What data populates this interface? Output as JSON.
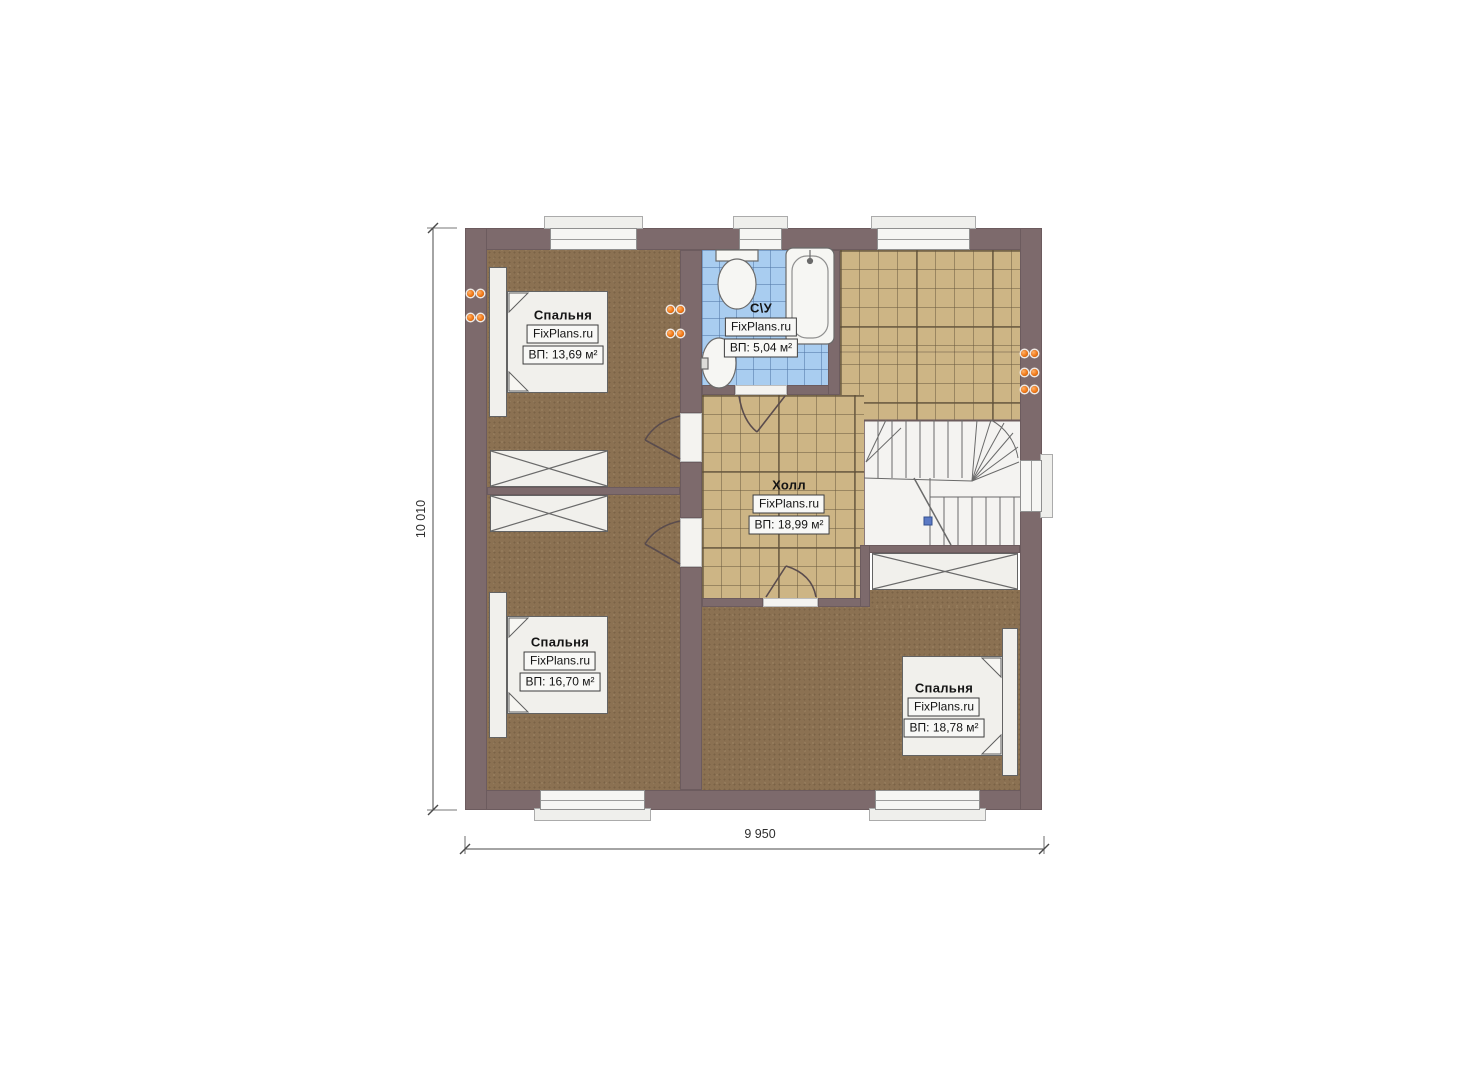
{
  "plan": {
    "rooms": [
      {
        "name": "Спальня",
        "brand": "FixPlans.ru",
        "area": "ВП: 13,69 м²"
      },
      {
        "name": "С\\У",
        "brand": "FixPlans.ru",
        "area": "ВП: 5,04 м²"
      },
      {
        "name": "Холл",
        "brand": "FixPlans.ru",
        "area": "ВП: 18,99 м²"
      },
      {
        "name": "Спальня",
        "brand": "FixPlans.ru",
        "area": "ВП: 16,70 м²"
      },
      {
        "name": "Спальня",
        "brand": "FixPlans.ru",
        "area": "ВП: 18,78 м²"
      }
    ],
    "dimensions": {
      "height": "10 010",
      "width": "9 950"
    },
    "colors": {
      "wall": "#7d6a6c",
      "carpet_floor": "#8b7152",
      "tile_floor": "#cdb585",
      "bath_tile_floor": "#a9cdf0",
      "socket": "#f07818",
      "furniture": "#f1f0ec"
    }
  }
}
